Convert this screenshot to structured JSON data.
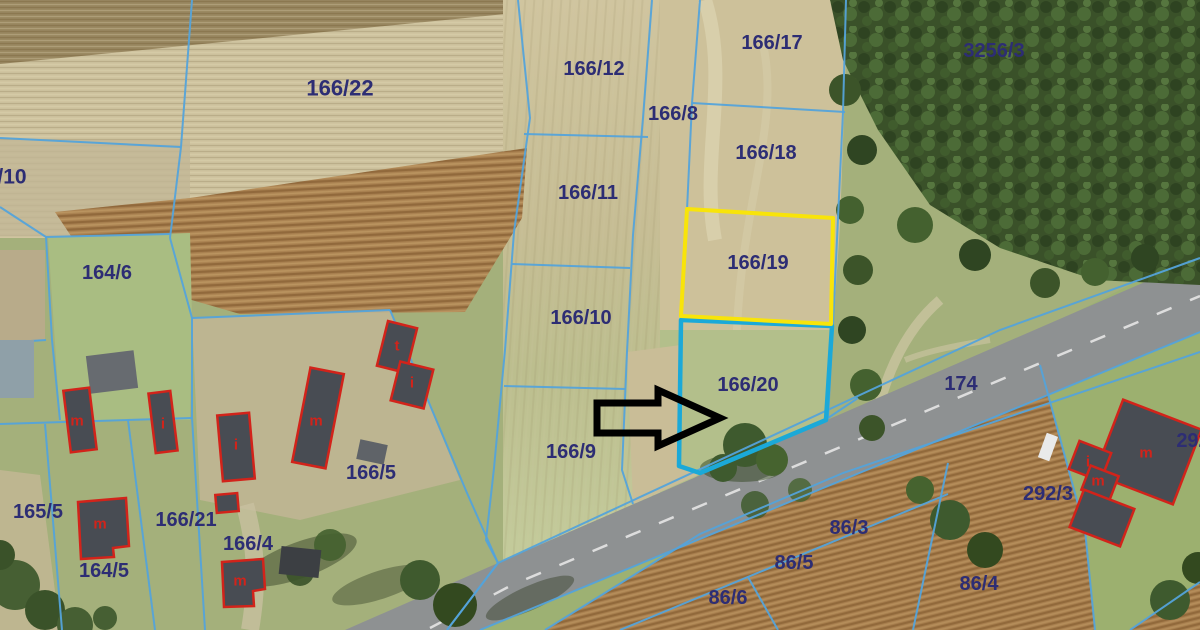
{
  "map": {
    "description": "Aerial orthophoto cadastral map with parcel boundaries",
    "highlighted_parcels": [
      {
        "id": "166/19",
        "color_key": "highlight_yellow"
      },
      {
        "id": "166/20",
        "color_key": "highlight_cyan"
      }
    ],
    "arrow": {
      "points_to": "166/20"
    },
    "parcel_labels": [
      {
        "text": "166/22",
        "x": 340,
        "y": 88,
        "size": 22
      },
      {
        "text": "/10",
        "x": 12,
        "y": 176,
        "size": 21
      },
      {
        "text": "164/6",
        "x": 107,
        "y": 272,
        "size": 20
      },
      {
        "text": "166/12",
        "x": 594,
        "y": 68,
        "size": 20
      },
      {
        "text": "166/8",
        "x": 673,
        "y": 113,
        "size": 20
      },
      {
        "text": "166/17",
        "x": 772,
        "y": 42,
        "size": 20
      },
      {
        "text": "166/18",
        "x": 766,
        "y": 152,
        "size": 20
      },
      {
        "text": "3256/3",
        "x": 994,
        "y": 50,
        "size": 20
      },
      {
        "text": "166/11",
        "x": 588,
        "y": 192,
        "size": 20
      },
      {
        "text": "166/10",
        "x": 581,
        "y": 317,
        "size": 20
      },
      {
        "text": "166/19",
        "x": 758,
        "y": 262,
        "size": 20
      },
      {
        "text": "166/20",
        "x": 748,
        "y": 384,
        "size": 20
      },
      {
        "text": "166/9",
        "x": 571,
        "y": 451,
        "size": 20
      },
      {
        "text": "166/5",
        "x": 371,
        "y": 472,
        "size": 20
      },
      {
        "text": "165/5",
        "x": 38,
        "y": 511,
        "size": 20
      },
      {
        "text": "166/21",
        "x": 186,
        "y": 519,
        "size": 20
      },
      {
        "text": "164/5",
        "x": 104,
        "y": 570,
        "size": 20
      },
      {
        "text": "166/4",
        "x": 248,
        "y": 543,
        "size": 20
      },
      {
        "text": "86/3",
        "x": 849,
        "y": 527,
        "size": 20
      },
      {
        "text": "86/5",
        "x": 794,
        "y": 562,
        "size": 20
      },
      {
        "text": "86/6",
        "x": 728,
        "y": 597,
        "size": 20
      },
      {
        "text": "86/4",
        "x": 979,
        "y": 583,
        "size": 20
      },
      {
        "text": "174",
        "x": 961,
        "y": 383,
        "size": 20
      },
      {
        "text": "292/3",
        "x": 1048,
        "y": 493,
        "size": 20
      },
      {
        "text": "292",
        "x": 1193,
        "y": 440,
        "size": 20
      }
    ],
    "building_labels": [
      {
        "text": "m",
        "x": 77,
        "y": 420
      },
      {
        "text": "i",
        "x": 163,
        "y": 423
      },
      {
        "text": "i",
        "x": 236,
        "y": 444
      },
      {
        "text": "m",
        "x": 100,
        "y": 523
      },
      {
        "text": "m",
        "x": 240,
        "y": 580
      },
      {
        "text": "m",
        "x": 316,
        "y": 420
      },
      {
        "text": "t",
        "x": 397,
        "y": 345
      },
      {
        "text": "i",
        "x": 412,
        "y": 382
      },
      {
        "text": "i",
        "x": 1088,
        "y": 461
      },
      {
        "text": "m",
        "x": 1098,
        "y": 480
      },
      {
        "text": "m",
        "x": 1146,
        "y": 452
      }
    ],
    "colors": {
      "parcel_line": "#54a3da",
      "parcel_label": "#2d2d74",
      "building_outline": "#d2231a",
      "building_label": "#d2231a",
      "highlight_yellow": "#f8e40a",
      "highlight_cyan": "#1ba9d8",
      "arrow_color": "#000000",
      "road_gray": "#8e9192",
      "forest_green": "#3a5129",
      "field_tan": "#cfc4a0",
      "field_brown": "#a87f4e",
      "grass_green": "#a4b07b"
    }
  }
}
